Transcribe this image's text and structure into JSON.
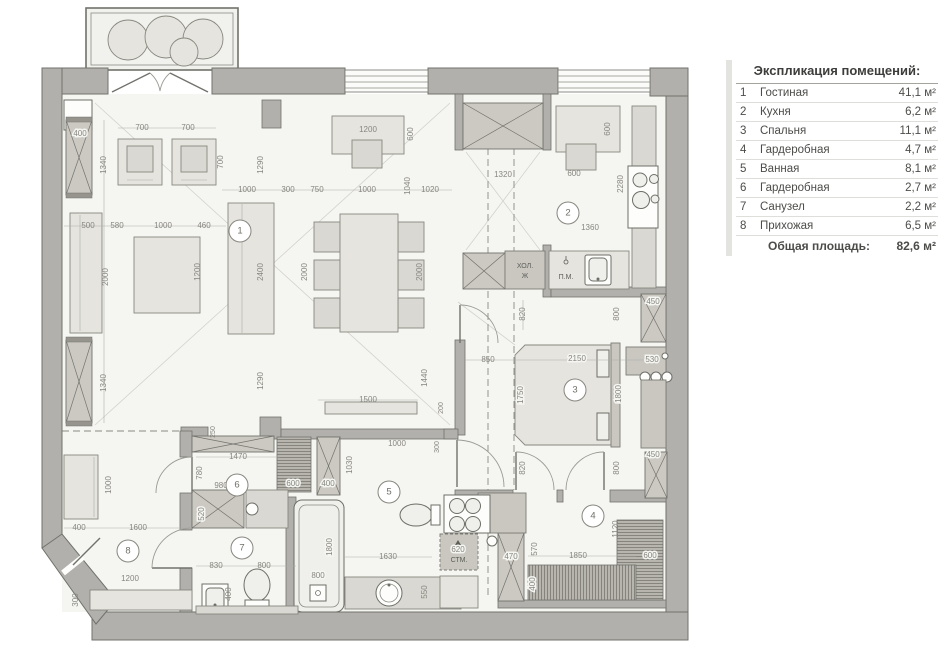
{
  "legend": {
    "title": "Экспликация помещений:",
    "rows": [
      {
        "num": "1",
        "name": "Гостиная",
        "area": "41,1 м²"
      },
      {
        "num": "2",
        "name": "Кухня",
        "area": "6,2 м²"
      },
      {
        "num": "3",
        "name": "Спальня",
        "area": "11,1 м²"
      },
      {
        "num": "4",
        "name": "Гардеробная",
        "area": "4,7 м²"
      },
      {
        "num": "5",
        "name": "Ванная",
        "area": "8,1 м²"
      },
      {
        "num": "6",
        "name": "Гардеробная",
        "area": "2,7 м²"
      },
      {
        "num": "7",
        "name": "Санузел",
        "area": "2,2 м²"
      },
      {
        "num": "8",
        "name": "Прихожая",
        "area": "6,5 м²"
      }
    ],
    "total_label": "Общая площадь:",
    "total_value": "82,6 м²"
  },
  "plan": {
    "room_numbers": [
      "1",
      "2",
      "3",
      "4",
      "5",
      "6",
      "7",
      "8"
    ],
    "labels": {
      "fridge_line1": "ХОЛ.",
      "fridge_line2": "Ж",
      "dishwasher": "П.М.",
      "washer": "СТМ."
    },
    "dims": [
      "700",
      "700",
      "400",
      "1340",
      "700",
      "1290",
      "1000",
      "300",
      "750",
      "1000",
      "1040",
      "1020",
      "1200",
      "600",
      "500",
      "580",
      "1000",
      "460",
      "2000",
      "1200",
      "2400",
      "2000",
      "2000",
      "1340",
      "1290",
      "1500",
      "200",
      "1440",
      "300",
      "1320",
      "600",
      "600",
      "2280",
      "1360",
      "820",
      "800",
      "850",
      "2150",
      "1750",
      "1800",
      "530",
      "450",
      "450",
      "820",
      "800",
      "1470",
      "780",
      "980",
      "600",
      "400",
      "520",
      "1030",
      "1000",
      "250",
      "1630",
      "550",
      "800",
      "1800",
      "620",
      "1000",
      "400",
      "1600",
      "1200",
      "300",
      "830",
      "800",
      "400",
      "570",
      "1850",
      "600",
      "1120",
      "470",
      "400"
    ]
  },
  "colors": {
    "wall": "#b1b0ac",
    "furniture": "#e5e4de",
    "floor": "#f5f5f2",
    "dimension_text": "#87867f",
    "legend_text": "#4c4c49"
  }
}
